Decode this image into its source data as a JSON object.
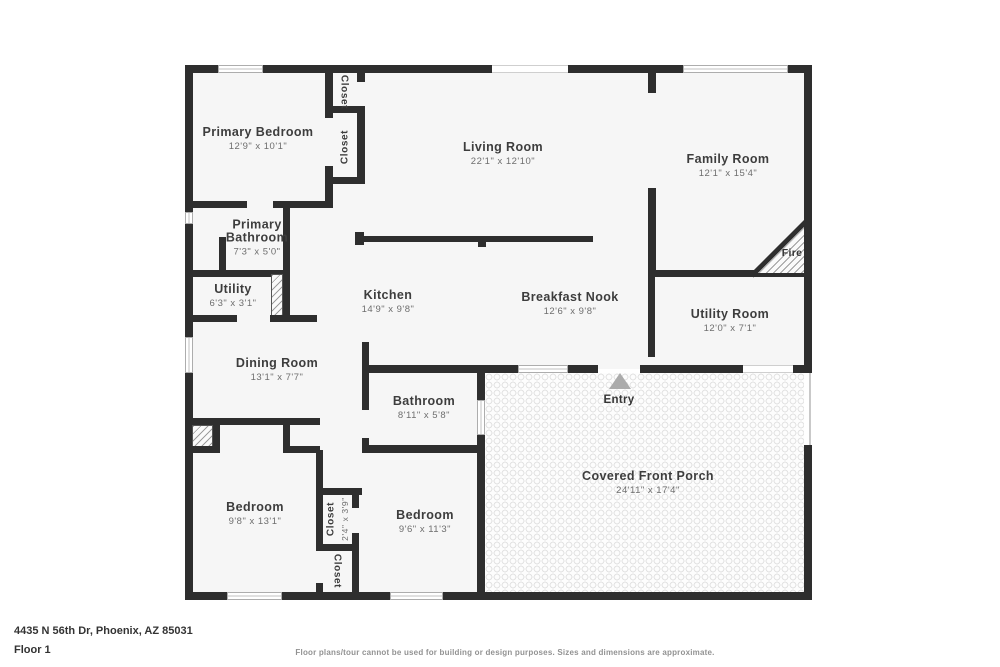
{
  "address": "4435 N 56th Dr, Phoenix, AZ 85031",
  "floor_label": "Floor 1",
  "disclaimer": "Floor plans/tour cannot be used for building or design purposes. Sizes and dimensions are approximate.",
  "colors": {
    "wall": "#2e2e2e",
    "floor": "#f6f6f6",
    "room_name_text": "#3d3d3d",
    "dims_text": "#6e6e6e",
    "entry_marker": "#ababab"
  },
  "rooms": [
    {
      "name": "Primary Bedroom",
      "dims": "12'9\" x 10'1\""
    },
    {
      "name": "Living Room",
      "dims": "22'1\" x 12'10\""
    },
    {
      "name": "Family Room",
      "dims": "12'1\" x 15'4\""
    },
    {
      "name": "Primary Bathroom",
      "dims": "7'3\" x 5'0\""
    },
    {
      "name": "Utility",
      "dims": "6'3\" x 3'1\""
    },
    {
      "name": "Kitchen",
      "dims": "14'9\" x 9'8\""
    },
    {
      "name": "Breakfast Nook",
      "dims": "12'6\" x 9'8\""
    },
    {
      "name": "Utility Room",
      "dims": "12'0\" x 7'1\""
    },
    {
      "name": "Dining Room",
      "dims": "13'1\" x 7'7\""
    },
    {
      "name": "Bathroom",
      "dims": "8'11\" x 5'8\""
    },
    {
      "name": "Bedroom",
      "dims": "9'8\" x 13'1\""
    },
    {
      "name": "Bedroom",
      "dims": "9'6\" x 11'3\""
    },
    {
      "name": "Covered Front Porch",
      "dims": "24'11\" x 17'4\""
    }
  ],
  "closets": [
    {
      "label": "Closet"
    },
    {
      "label": "Closet"
    },
    {
      "label": "Closet",
      "dims": "2'4\" x 3'9\""
    },
    {
      "label": "Closet"
    }
  ],
  "labels": {
    "fire": "Fire",
    "entry": "Entry"
  }
}
